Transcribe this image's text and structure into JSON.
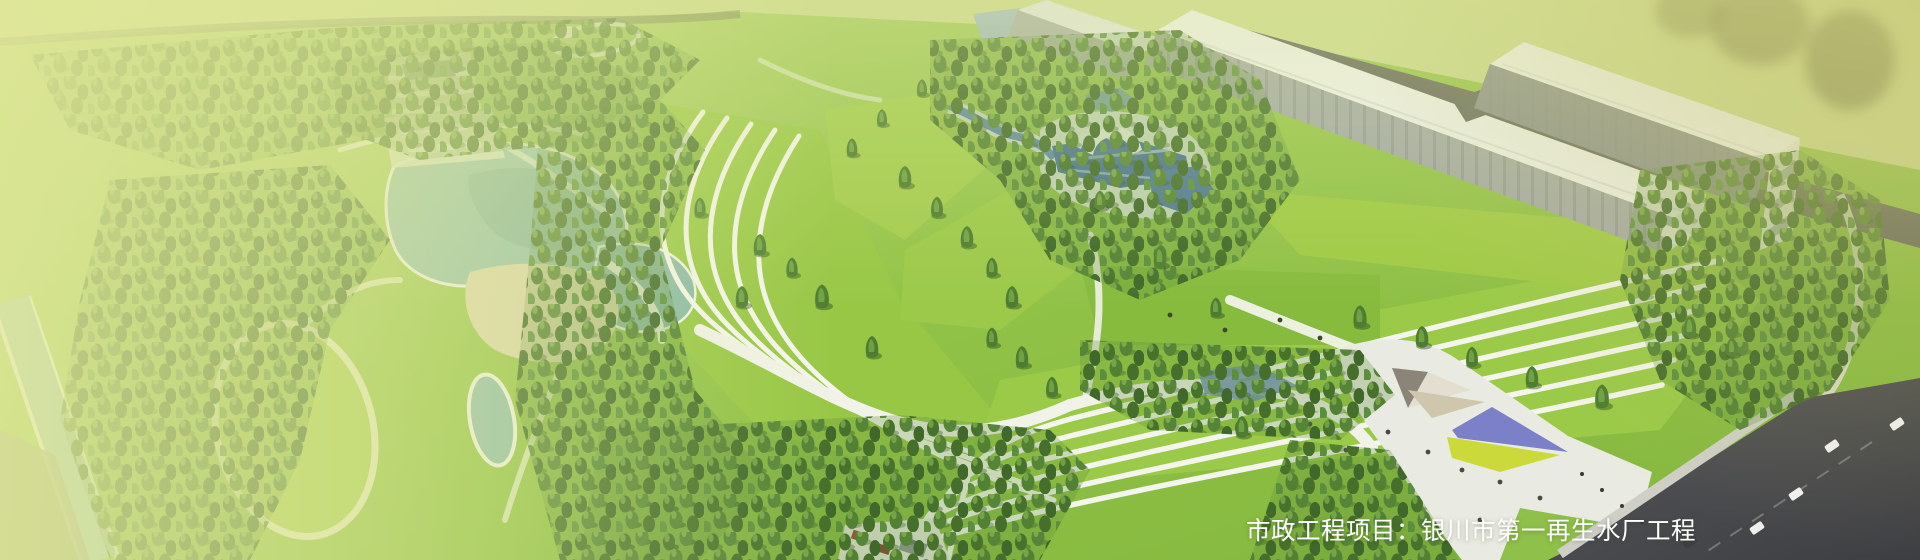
{
  "banner": {
    "caption": "市政工程项目：银川市第一再生水厂工程",
    "caption_label": "市政工程项目",
    "project_name": "银川市第一再生水厂工程",
    "text_color": "#ffffff"
  },
  "palette": {
    "lawn_green": "#8fc243",
    "forest_green": "#4a7830",
    "lake_teal": "#93bfae",
    "pool_blue": "#3f68ae",
    "road_gray": "#46474c",
    "plaza_white": "#e9eae1",
    "amphitheater_purple": "#7b80c8",
    "amphitheater_yellow": "#ccd93a",
    "wash_tint": "#e2e99e"
  }
}
